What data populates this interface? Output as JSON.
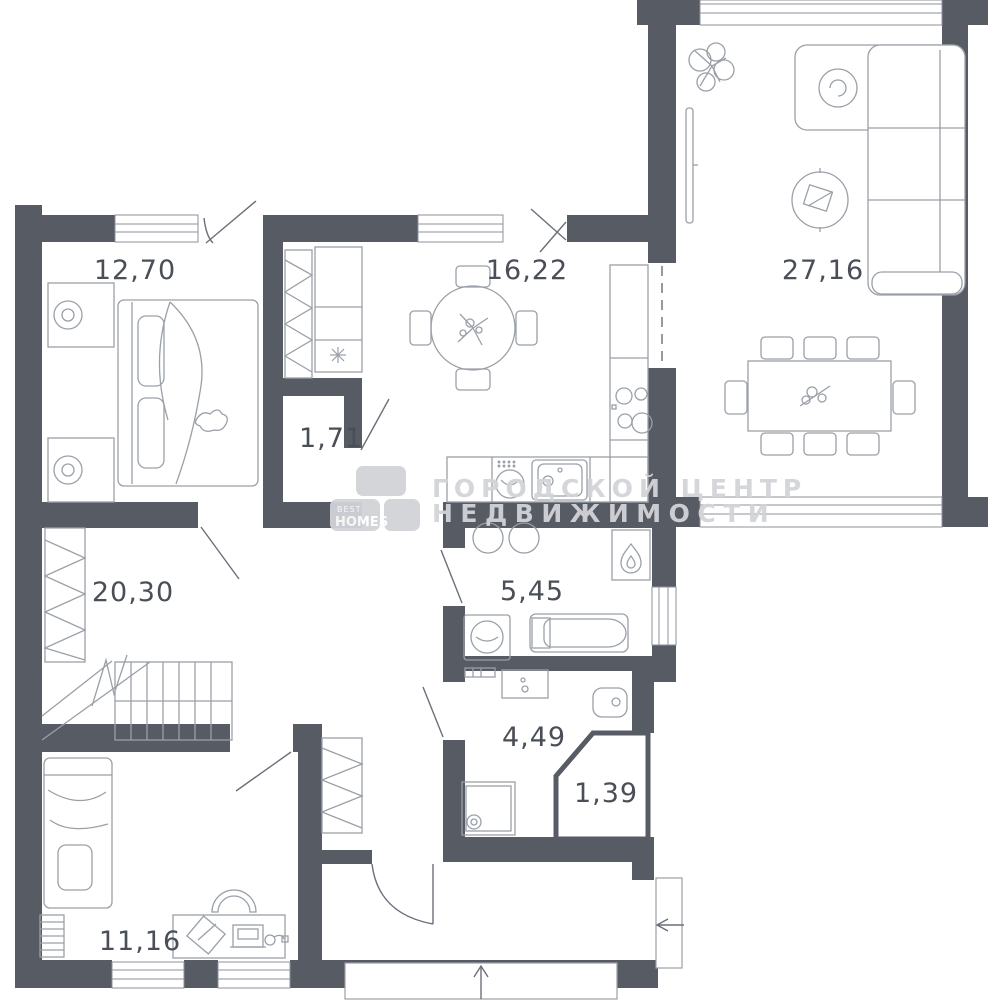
{
  "watermark": {
    "line1": "ГОРОДСКОЙ ЦЕНТР",
    "line2": "НЕДВИЖИМОСТИ",
    "logo_top": "BEST",
    "logo_bottom": "HOMES"
  },
  "rooms": {
    "bedroom": {
      "area": "12,70"
    },
    "kitchen": {
      "area": "16,22"
    },
    "living": {
      "area": "27,16"
    },
    "closet": {
      "area": "1,71"
    },
    "hallway": {
      "area": "20,30"
    },
    "bathroom": {
      "area": "5,45"
    },
    "wc": {
      "area": "4,49"
    },
    "shower": {
      "area": "1,39"
    },
    "study": {
      "area": "11,16"
    }
  },
  "colors": {
    "wall": "#575b64",
    "furniture_line": "#9aa0a8",
    "label_text": "#4a4e57",
    "watermark": "#d3d4d8"
  }
}
